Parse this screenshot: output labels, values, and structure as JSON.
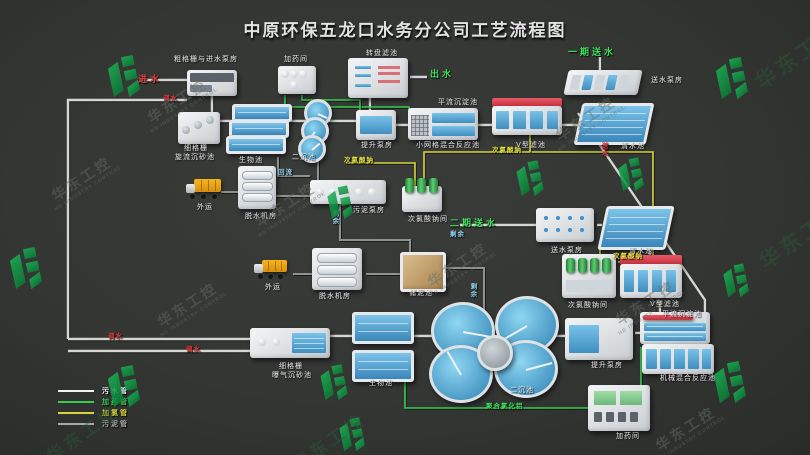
{
  "title": "中原环保五龙口水务分公司工艺流程图",
  "company": {
    "name": "华东工控",
    "subtitle": "HD INDUSTRY CONTROL"
  },
  "legend": [
    {
      "label": "污水管",
      "color": "#f2f2f2"
    },
    {
      "label": "加药管",
      "color": "#38cf50"
    },
    {
      "label": "加氯管",
      "color": "#d6d63a"
    },
    {
      "label": "污泥管",
      "color": "#a8a8a8"
    }
  ],
  "units": {
    "cu_gezha": "粗格栅与进水泵房",
    "jiayaojian": "加药间",
    "xigezha1a": "细格栅",
    "xigezha1b": "旋流沉砂池",
    "shengwuchi": "生物池",
    "erchenchi": "二沉池",
    "tishengbengfang": "提升泵房",
    "zhuanpanlvchi": "转盘滤池",
    "pingliu": "平流沉淀池",
    "xiaowangge": "小网格混合反应池",
    "vxinglvchi": "V型滤池",
    "qingshuichi": "清水池",
    "songshuibengfang": "送水泵房",
    "waiyun": "外运",
    "tuoshuijifang": "脱水机房",
    "wunibengfang": "污泥泵房",
    "cilvsuannajian": "次氯酸钠间",
    "chunichi": "储泥池",
    "xigezha2a": "细格栅",
    "xigezha2b": "曝气沉砂池",
    "jixie": "机械混合反应池"
  },
  "flows": {
    "jinshui": "进水",
    "tiaoshui": "调水",
    "chushui": "出水",
    "yiqisongshui": "一期送水",
    "erqisongshui": "二期送水",
    "cilvsuanna": "次氯酸钠",
    "huiliu": "回流",
    "shengyu": "剩余",
    "juhelvhualv": "聚合氯化铝",
    "songshui": "送水"
  }
}
